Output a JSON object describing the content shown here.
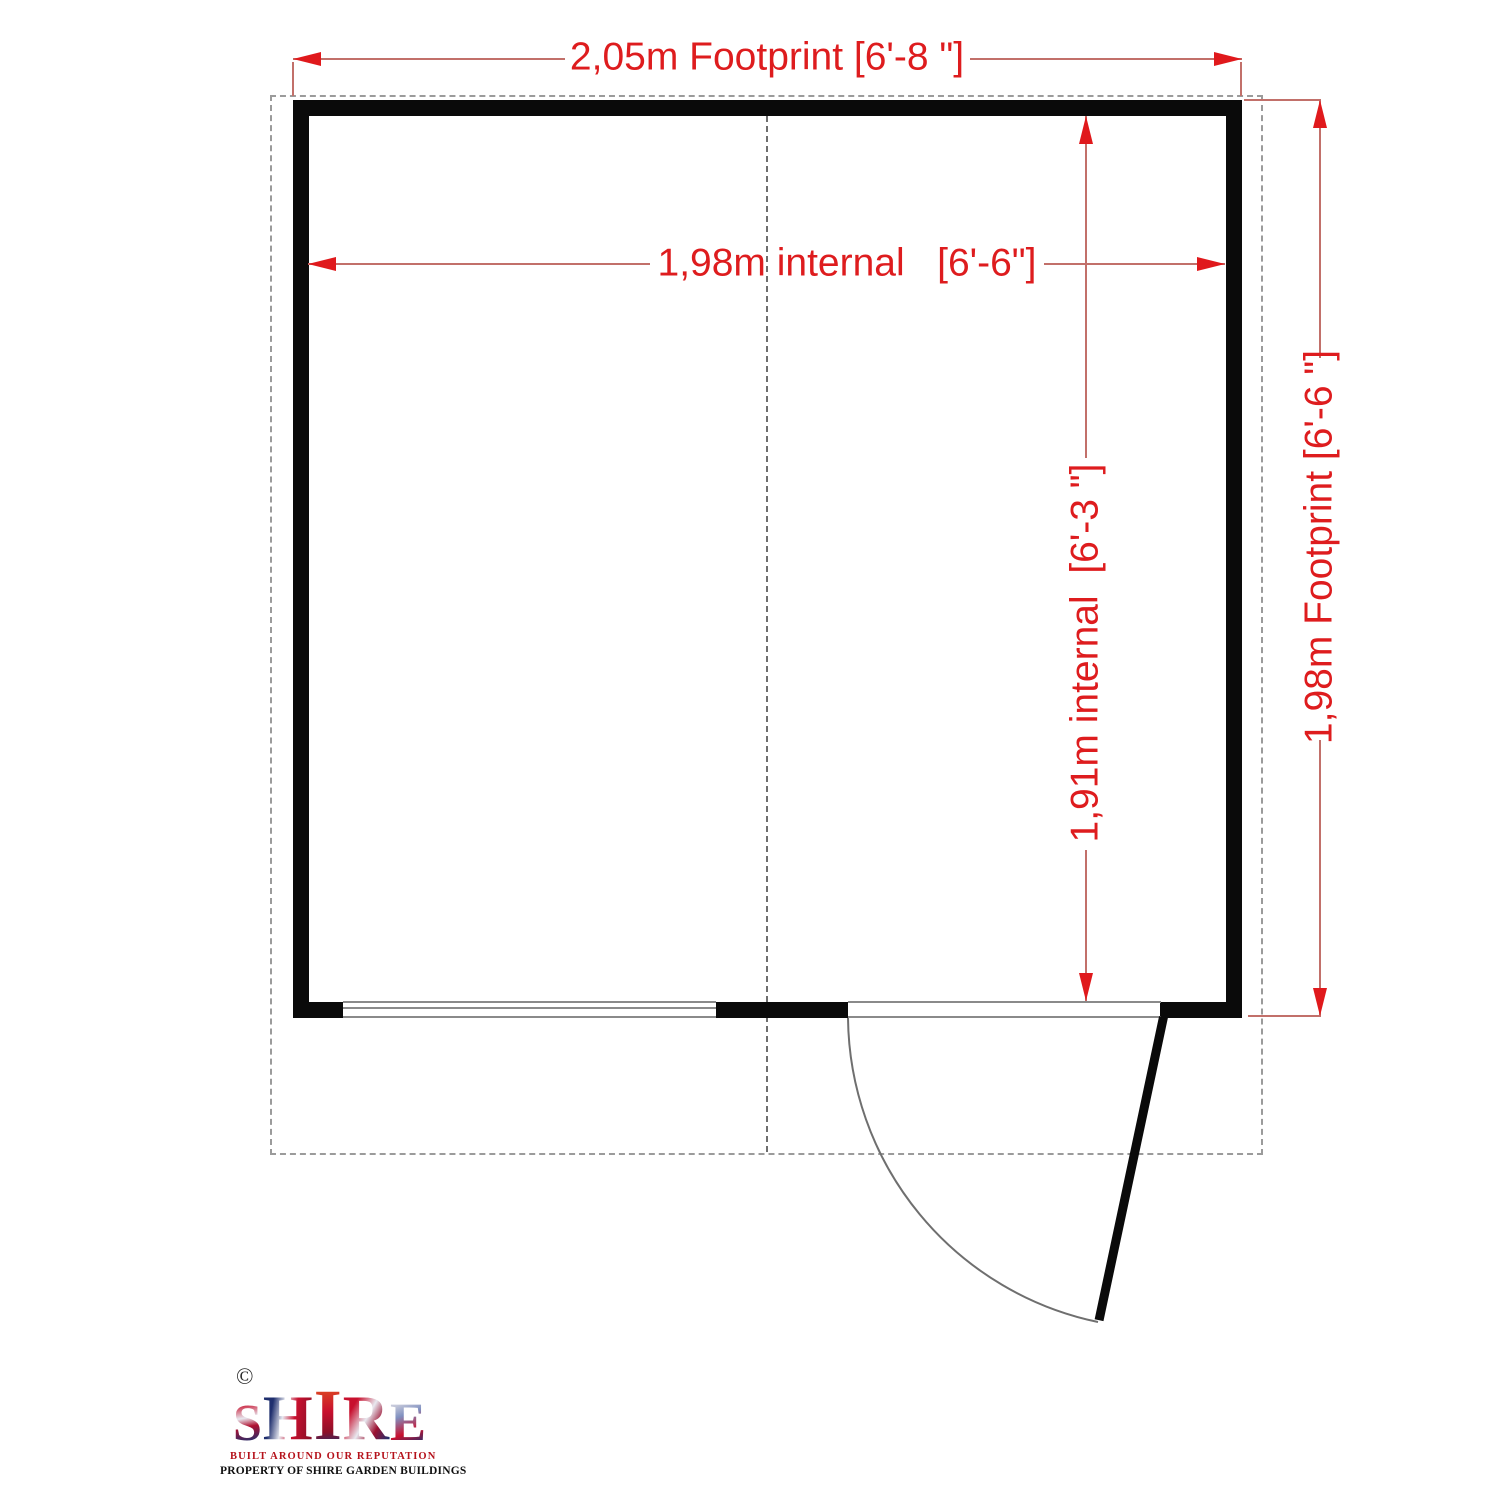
{
  "diagram": {
    "type": "shed floor plan",
    "dimensions": {
      "width_footprint": "2,05m Footprint [6'-8 \"]",
      "width_internal": "1,98m internal   [6'-6\"]",
      "depth_internal": "1,91m internal  [6'-3 \"]",
      "depth_footprint": "1,98m Footprint [6'-6 \"]"
    },
    "colors": {
      "dimension_text_red": "#de1c1e",
      "dimension_line_red": "#c2706a",
      "wall_black": "#0a0a0a",
      "detail_gray": "#8a8a8a"
    }
  },
  "branding": {
    "copyright": "©",
    "brand": "SHIRE",
    "brand_letters": [
      "S",
      "H",
      "I",
      "R",
      "E"
    ],
    "tagline": "BUILT AROUND OUR REPUTATION",
    "property_line": "PROPERTY OF SHIRE GARDEN BUILDINGS"
  }
}
